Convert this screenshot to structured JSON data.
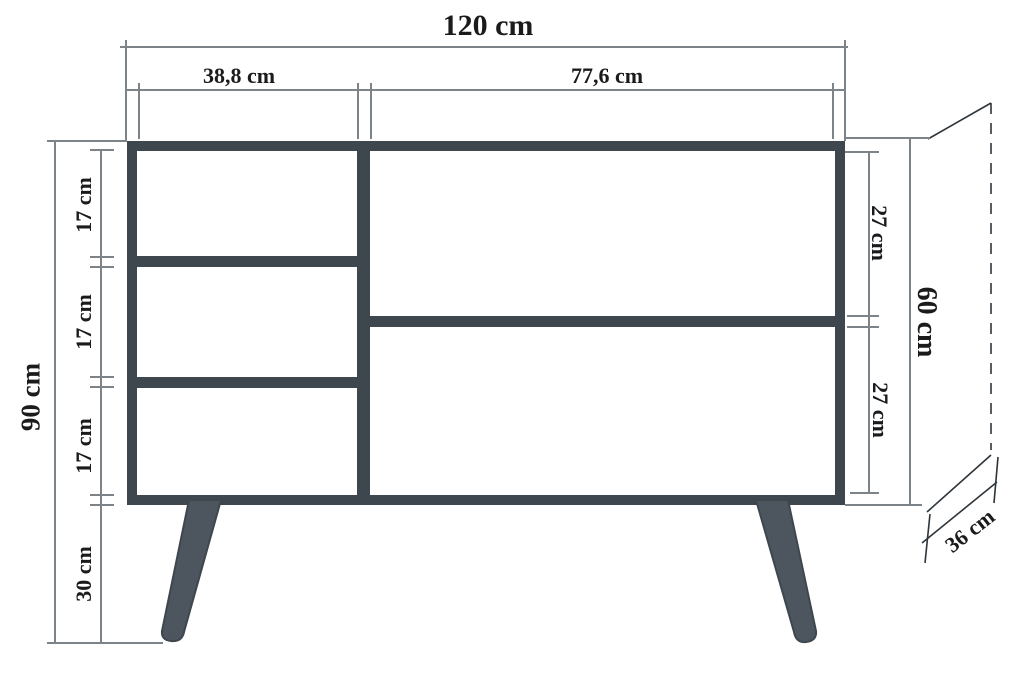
{
  "diagram": {
    "title": "sideboard-dimension-drawing",
    "unit": "cm",
    "labels": {
      "total_width": "120 cm",
      "left_section_width": "38,8 cm",
      "right_section_width": "77,6 cm",
      "total_height": "90 cm",
      "left_compartment_1": "17 cm",
      "left_compartment_2": "17 cm",
      "left_compartment_3": "17 cm",
      "leg_height": "30 cm",
      "right_compartment_top": "27 cm",
      "body_height": "60 cm",
      "right_compartment_bottom": "27 cm",
      "depth": "36 cm"
    },
    "colors": {
      "frame": "#3e474e",
      "leg": "#4d565e",
      "dimension_line": "#7c8489",
      "projection_line": "#2e353a",
      "text": "#1b1b1b",
      "background": "#ffffff"
    }
  }
}
